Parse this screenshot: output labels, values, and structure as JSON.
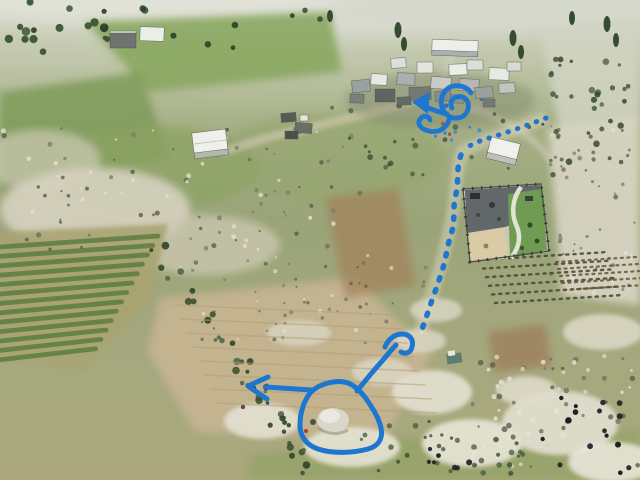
{
  "image": {
    "type": "annotated-aerial-drone-photograph",
    "description": "Oblique aerial view of a small hilltop village of white and grey flat-roofed buildings, surrounded by green pasture, a bright green meadow upper-left, a terraced vineyard lower-left, a fenced compound with scorched dark ground, sand and a green lawn at mid-right, pale rocky mounds and scattered black tires lower-right. Hand-drawn blue markings annotate a route.",
    "annotation_color": "#1d76cf"
  },
  "scene": {
    "regions": [
      {
        "name": "village-cluster",
        "desc": "dense group of small white, grey and dark flat-roofed buildings on the hilltop"
      },
      {
        "name": "walled-compound",
        "desc": "fenced yard with dark scorched pavement, sandy patch and green lawn crossed by a white path"
      },
      {
        "name": "terraced-vineyard",
        "desc": "diagonal dark-green planted rows on the lower-left slope"
      },
      {
        "name": "circled-structure",
        "desc": "white domed rock/structure enclosed by the blue freehand circle"
      },
      {
        "name": "tire-scatter",
        "desc": "black tires scattered over pale rocky ground, lower right"
      },
      {
        "name": "olive-grove",
        "desc": "olive trees along the upper-left ridge"
      }
    ]
  },
  "annotations": {
    "color": "#1d76cf",
    "items": [
      {
        "name": "village-loop",
        "kind": "freehand loop circling a spot in the village with an arrow pointing left"
      },
      {
        "name": "dotted-route",
        "kind": "dotted trail descending from the village toward the circled structure"
      },
      {
        "name": "bottom-enclosure",
        "kind": "large freehand circle around the white domed structure"
      },
      {
        "name": "arrow-northeast",
        "kind": "arrow from the circle pointing up-right toward the dotted trail"
      },
      {
        "name": "arrow-west",
        "kind": "arrow from the circle pointing left"
      }
    ],
    "paths": {
      "route_dots_upper": "M 546,118 C 526,126 505,133 486,139 C 476,142 468,146 463,151",
      "route_dots_main": "M 461,155 C 456,168 459,181 456,194 C 452,208 456,221 451,234 C 447,247 446,259 442,271 C 438,284 433,297 429,309 C 426,318 423,327 420,334",
      "village_loop": "M 471,93 C 466,85 453,83 446,90 C 439,97 440,109 447,115 C 455,121 466,118 468,109 C 470,101 464,95 457,97 C 452,98 449,103 452,108",
      "village_arrow_line": "M 447,114 C 439,112 433,110 426,107",
      "village_arrow_head": "412,102 430,92 428,114",
      "village_wiggle": "M 449,120 C 446,129 438,133 429,131 C 420,129 416,123 421,118 C 424,115 429,116 430,120",
      "enclosure": "M 312,391 C 320,384 336,379 348,383 C 356,386 362,393 367,400 C 373,409 379,418 381,428 C 383,438 379,446 368,449 C 353,453 333,454 318,449 C 306,445 300,436 300,425 C 300,413 304,399 312,391 Z",
      "arrow_west_line": "M 311,390 C 296,389 281,388 266,387",
      "arrow_west_head": "M 268,377 L 248,386 L 267,399",
      "arrow_ne_line": "M 357,391 C 365,381 374,370 383,360 C 388,354 392,349 396,345",
      "arrow_ne_head": "M 385,347 C 388,339 395,334 402,334 C 410,334 414,340 412,347 C 411,352 406,355 401,352"
    }
  }
}
